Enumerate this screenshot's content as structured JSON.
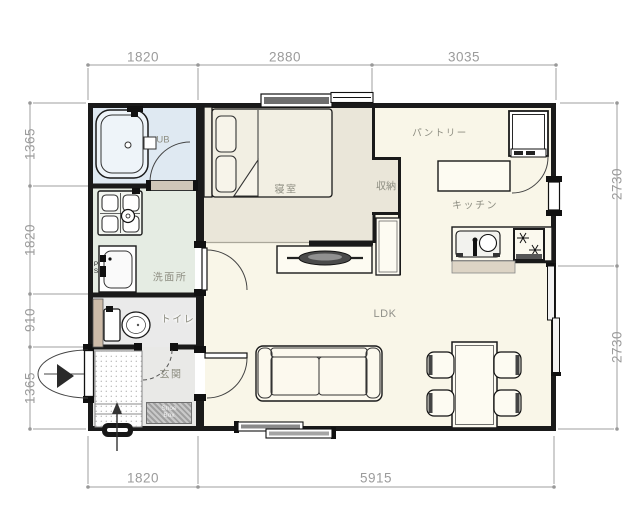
{
  "plan": {
    "dims": {
      "top": [
        "1820",
        "2880",
        "3035"
      ],
      "bottom": [
        "1820",
        "5915"
      ],
      "left": [
        "1365",
        "1820",
        "910",
        "1365"
      ],
      "right": [
        "2730",
        "2730"
      ]
    },
    "rooms": {
      "bath": "UB",
      "bedroom": "寝室",
      "closet": "収納",
      "pantry": "パントリー",
      "kitchen": "キッチン",
      "washroom": "洗面所",
      "toilet": "トイレ",
      "entrance": "玄関",
      "living": "LDK",
      "shoe_box": "Shoe Box",
      "pipe_space": "PS"
    },
    "colors": {
      "bath_fill": "#dfe9f2",
      "washroom_fill": "#e5ece3",
      "toilet_fill": "#eaeaea",
      "entrance_fill": "#e9e9e7",
      "bedroom_fill": "#eae6d9",
      "main_fill": "#f9f6e8",
      "wall": "#1a1a1a",
      "dimension_gray": "#9b9b9b"
    }
  }
}
